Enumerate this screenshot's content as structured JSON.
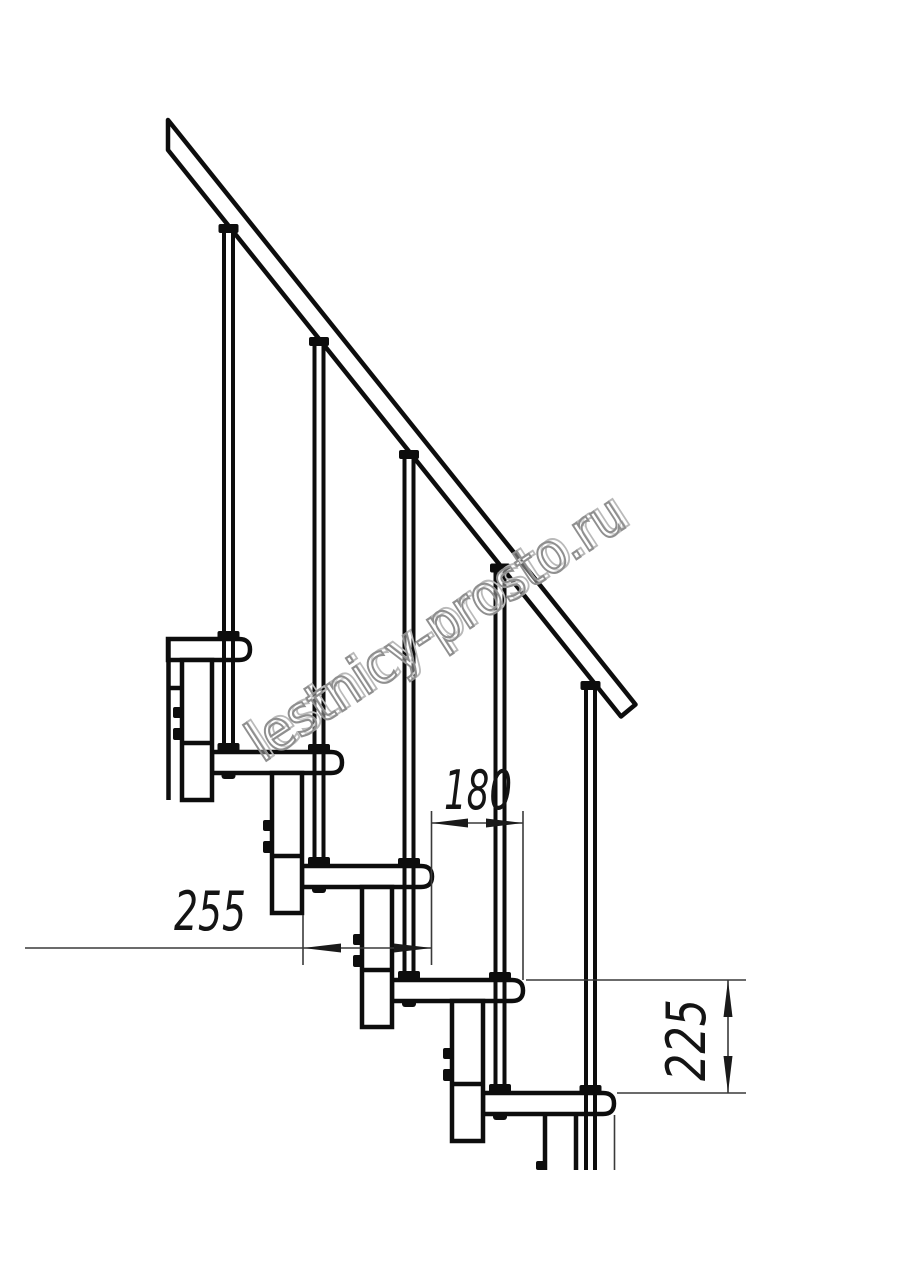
{
  "watermark": {
    "text": "lestnicy-prosto.ru"
  },
  "dimensions": {
    "tread_depth_mm": "255",
    "step_run_mm": "180",
    "step_rise_mm": "225"
  }
}
